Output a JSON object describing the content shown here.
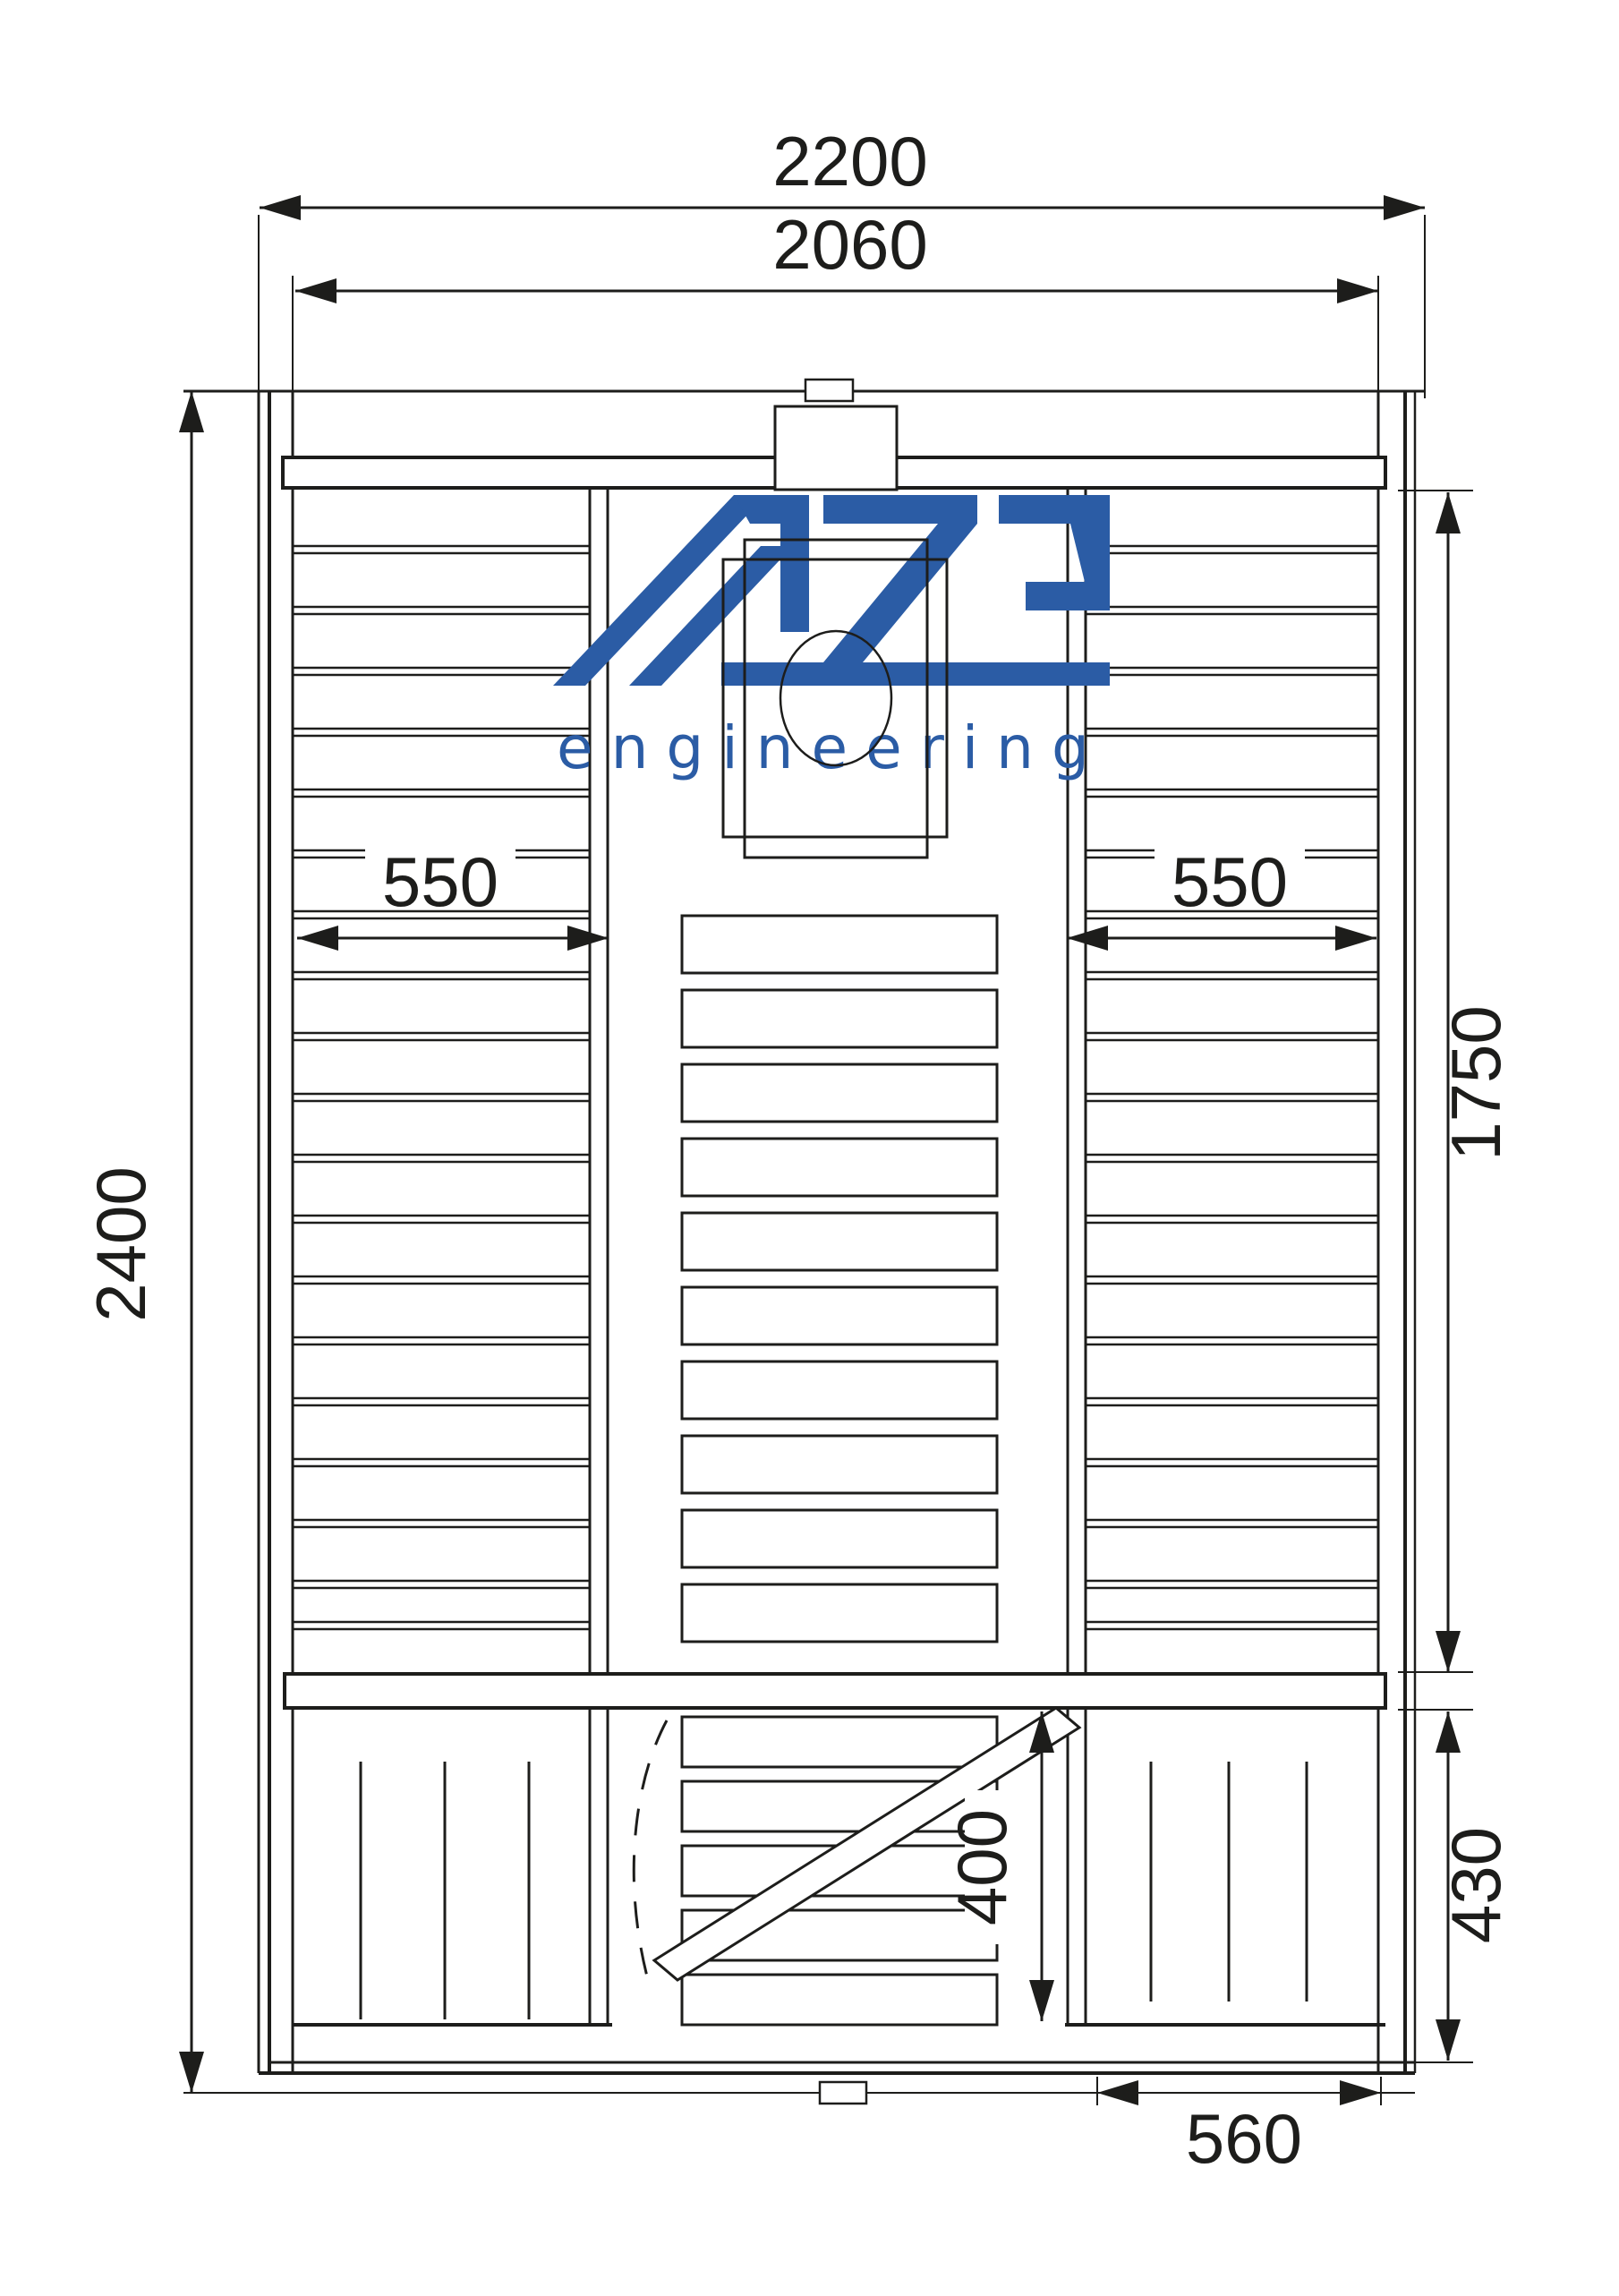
{
  "drawing": {
    "type": "technical floor plan, top view of sauna cabin",
    "line_color": "#1d1d1b",
    "background": "#ffffff"
  },
  "logo": {
    "brand": "AZS",
    "subtitle": "engineering",
    "color": "#2B5CA5"
  },
  "dimensions": {
    "overall_width": "2200",
    "inner_width": "2060",
    "overall_depth": "2400",
    "interior_depth": "1750",
    "left_bench_depth": "550",
    "right_bench_depth": "550",
    "door_opening": "400",
    "annex_depth": "430",
    "annex_right_width": "560"
  }
}
